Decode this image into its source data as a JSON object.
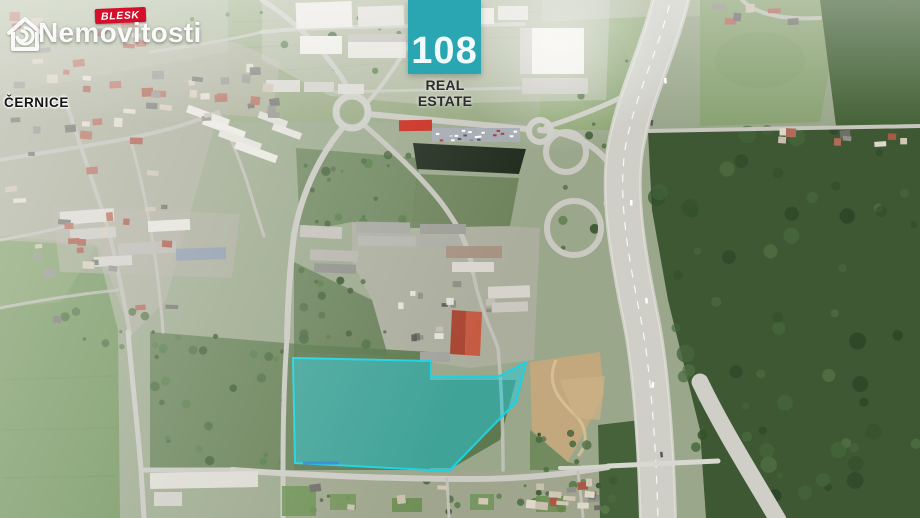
{
  "overlays": {
    "blesk_logo": {
      "badge": "BLESK",
      "wordmark": "Nemovitosti",
      "badge_color": "#d40e2b",
      "wordmark_color": "#ffffff",
      "icon": "house-icon"
    },
    "agency_logo": {
      "number": "108",
      "name": "REAL ESTATE",
      "square_color": "#29a6b2",
      "number_color": "#f2fbfb",
      "name_color": "#2b2d2e"
    },
    "place_label": "ČERNICE"
  },
  "parcel": {
    "points": "293,358 431,361 431,377 500,376 526,362 516,402 449,471 295,463",
    "fill": "rgba(33,205,223,0.5)",
    "stroke": "#1bd2e2",
    "marker_color": "#2e86d4"
  }
}
